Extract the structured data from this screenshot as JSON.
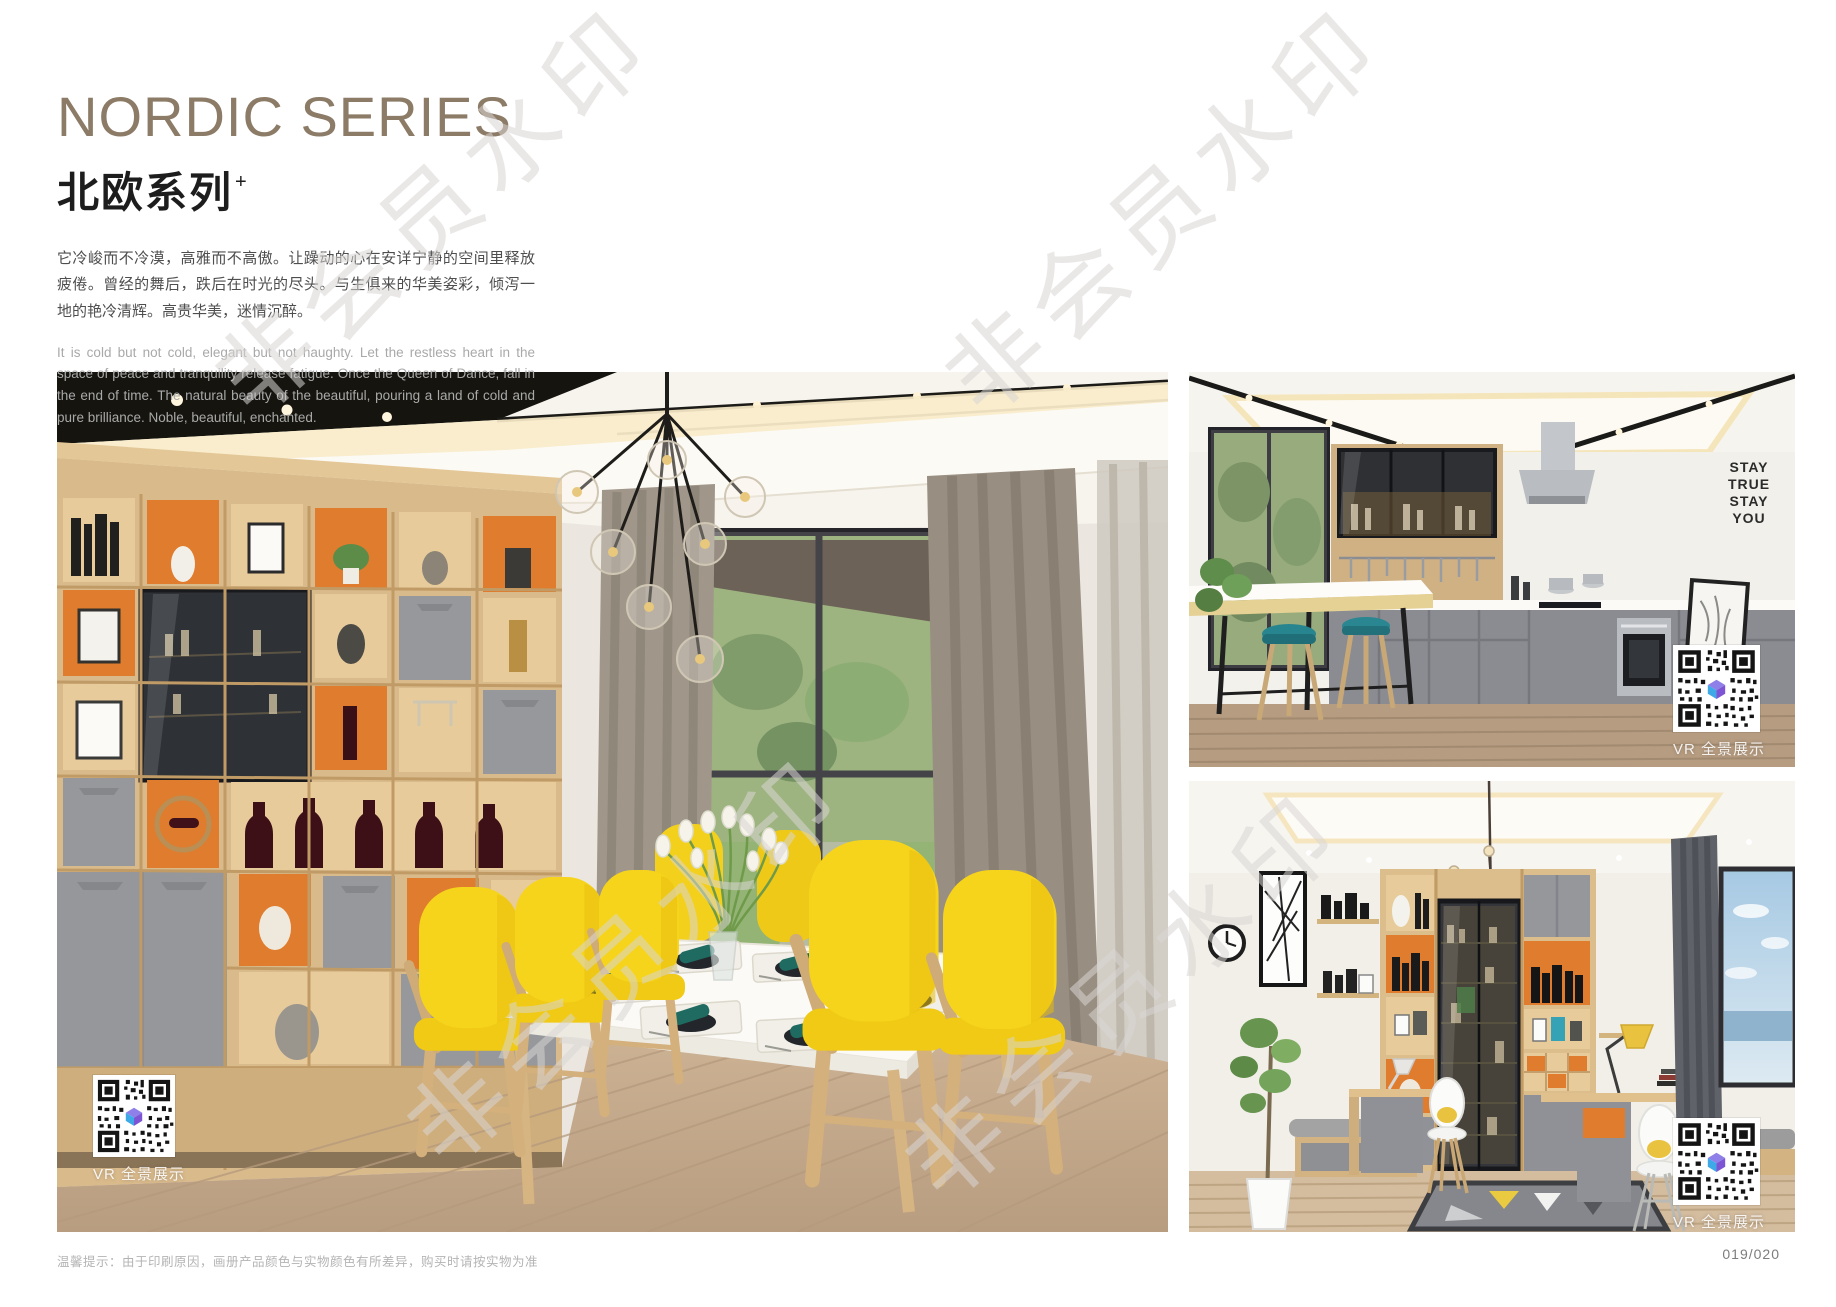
{
  "header": {
    "title": "NORDIC SERIES",
    "subtitle": "北欧系列",
    "subtitle_mark": "+",
    "paragraph_cn": "它冷峻而不冷漠，高雅而不高傲。让躁动的心在安详宁静的空间里释放疲倦。曾经的舞后，跌后在时光的尽头。与生俱来的华美姿彩，倾泻一地的艳冷清辉。高贵华美，迷情沉醉。",
    "paragraph_en": "It is cold but not cold, elegant but not haughty. Let the restless heart in the space of peace and tranquility release fatigue. Once the Queen of Dance, fall in the end of time. The natural beauty of the beautiful, pouring a land of cold and pure brilliance. Noble, beautiful, enchanted."
  },
  "images": {
    "dining": {
      "vr_label": "VR 全景展示"
    },
    "kitchen": {
      "vr_label": "VR 全景展示",
      "wall_art": [
        "STAY",
        "TRUE",
        "STAY",
        "YOU"
      ]
    },
    "study": {
      "vr_label": "VR 全景展示"
    }
  },
  "watermark": {
    "text": "非会员水印"
  },
  "footer": {
    "note": "温馨提示：由于印刷原因，画册产品颜色与实物颜色有所差异，购买时请按实物为准",
    "page_number": "019/020"
  },
  "colors": {
    "title": "#8C7B66",
    "text_dark": "#4E4E4E",
    "text_light": "#A9A9A9",
    "watermark": "#D8D6D3",
    "accent_orange": "#DF7C2D",
    "accent_yellow": "#F5D41C",
    "accent_teal": "#2A8791",
    "wood": "#D9BA8B",
    "cabinet_gray": "#95979B"
  }
}
